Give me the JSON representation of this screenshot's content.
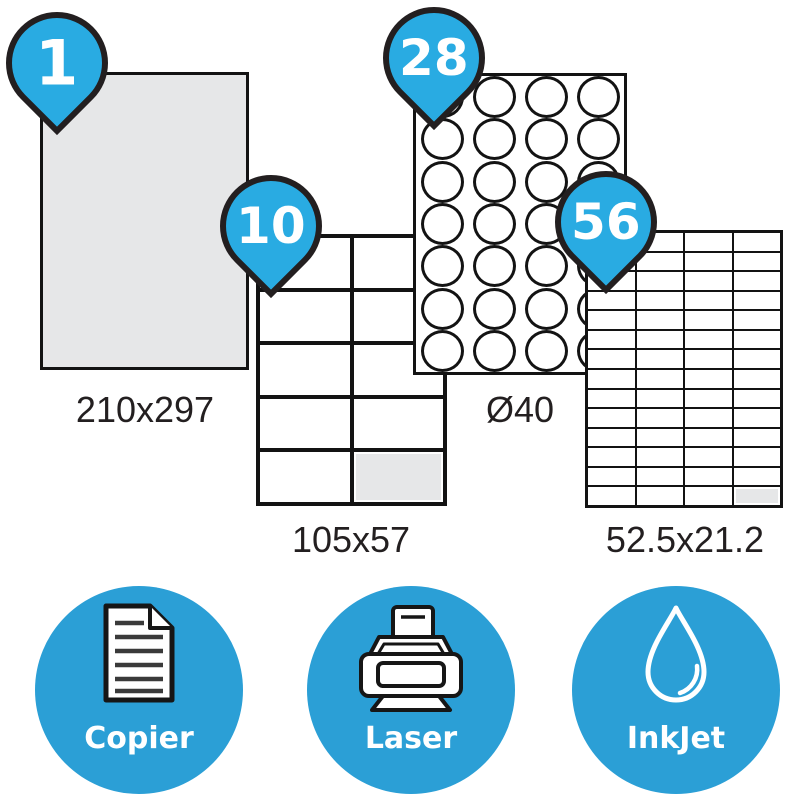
{
  "sheets": [
    {
      "name": "a4-single-label",
      "count": "1",
      "dimensions": "210x297",
      "cols": 1,
      "rows": 1,
      "shape": "rect",
      "peeled_last_cell": false
    },
    {
      "name": "10-labels",
      "count": "10",
      "dimensions": "105x57",
      "cols": 2,
      "rows": 5,
      "shape": "rect",
      "peeled_last_cell": true
    },
    {
      "name": "28-round-labels",
      "count": "28",
      "dimensions": "Ø40",
      "cols": 4,
      "rows": 7,
      "shape": "round",
      "peeled_last_cell": false
    },
    {
      "name": "56-labels",
      "count": "56",
      "dimensions": "52.5x21.2",
      "cols": 4,
      "rows": 14,
      "shape": "rect",
      "peeled_last_cell": true
    }
  ],
  "printers": [
    {
      "label": "Copier",
      "icon": "document-icon"
    },
    {
      "label": "Laser",
      "icon": "laser-printer-icon"
    },
    {
      "label": "InkJet",
      "icon": "ink-drop-icon"
    }
  ],
  "colors": {
    "accent": "#29ABE2",
    "badge": "#2B9FD6",
    "outline": "#231F20",
    "sheet_gray": "#E6E7E8"
  }
}
